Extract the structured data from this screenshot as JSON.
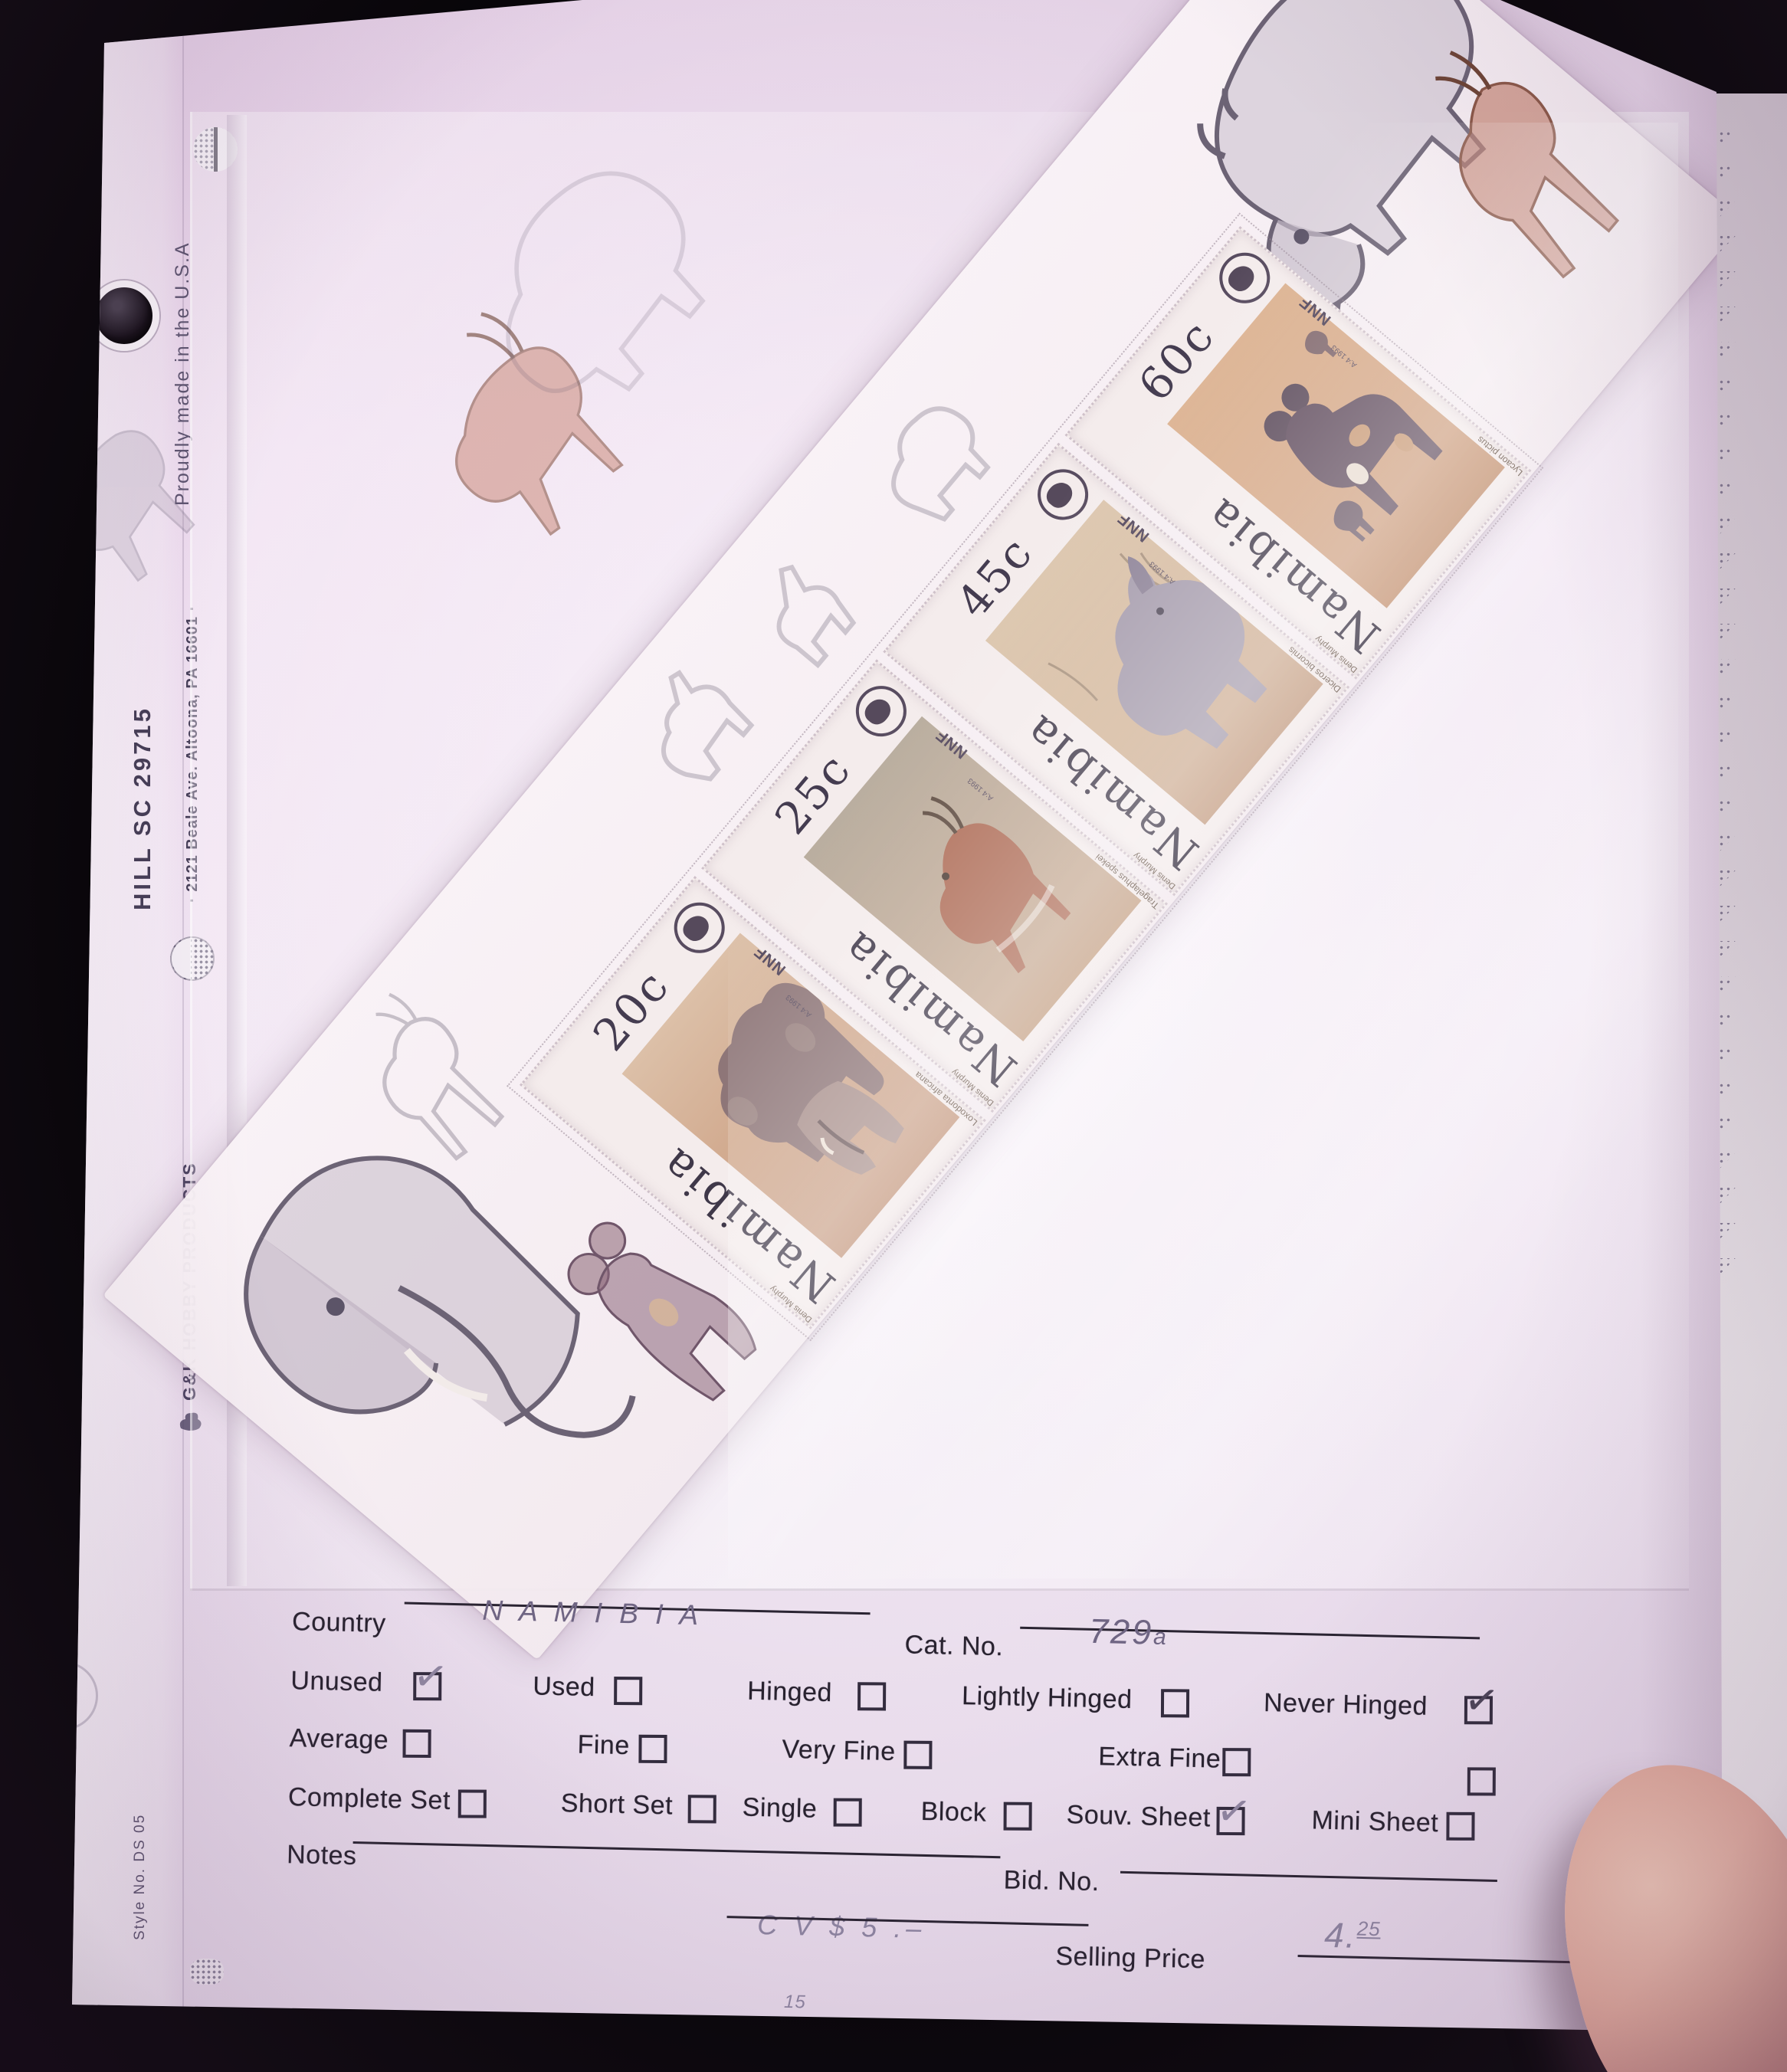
{
  "colors": {
    "page_pink": "#ecdcee",
    "sheet_white": "#f6eff3",
    "stamp_tan": "#d2ab90",
    "ink": "#28222f",
    "pencil": "#8d84a0",
    "handwriting": "#6f6583",
    "finger_skin": "#e2ac9d"
  },
  "page_edge": {
    "made_in": "Proudly made in the U.S.A",
    "address": "· 2121 Beale Ave. Altoona, PA  16601 ·",
    "brand": "G&K HOBBY PRODUCTS",
    "style_no": "Style No. DS 05",
    "handwritten_id": "HILL   SC  29715"
  },
  "sheet": {
    "country": "Namibia",
    "nnf": "NNF",
    "issue_note": "A:4 1993",
    "artist": "Denis Murphy",
    "stamps": [
      {
        "value": "20c",
        "species": "Loxodonta africana"
      },
      {
        "value": "25c",
        "species": "Tragelaphus spekei"
      },
      {
        "value": "45c",
        "species": "Diceros bicornis"
      },
      {
        "value": "60c",
        "species": "Lycaon pictus"
      }
    ]
  },
  "form": {
    "country_label": "Country",
    "country_value": "N A M I B I A",
    "cat_label": "Cat. No.",
    "cat_value": "729",
    "cat_value_suffix": "a",
    "checks_row1": [
      {
        "label": "Unused",
        "checked": true
      },
      {
        "label": "Used",
        "checked": false
      },
      {
        "label": "Hinged",
        "checked": false
      },
      {
        "label": "Lightly Hinged",
        "checked": false
      },
      {
        "label": "Never Hinged",
        "checked": true
      }
    ],
    "checks_row2": [
      {
        "label": "Average",
        "checked": false
      },
      {
        "label": "Fine",
        "checked": false
      },
      {
        "label": "Very Fine",
        "checked": false
      },
      {
        "label": "Extra Fine",
        "checked": false
      },
      {
        "label": "",
        "checked": false
      }
    ],
    "checks_row3": [
      {
        "label": "Complete Set",
        "checked": false
      },
      {
        "label": "Short Set",
        "checked": false
      },
      {
        "label": "Single",
        "checked": false
      },
      {
        "label": "Block",
        "checked": false
      },
      {
        "label": "Souv. Sheet",
        "checked": true
      },
      {
        "label": "Mini Sheet",
        "checked": false
      }
    ],
    "notes_label": "Notes",
    "bid_label": "Bid. No.",
    "cv_value": "C V  $ 5 .–",
    "selling_label": "Selling Price",
    "price_int": "4.",
    "price_cents": "25",
    "corner_note": "15"
  }
}
